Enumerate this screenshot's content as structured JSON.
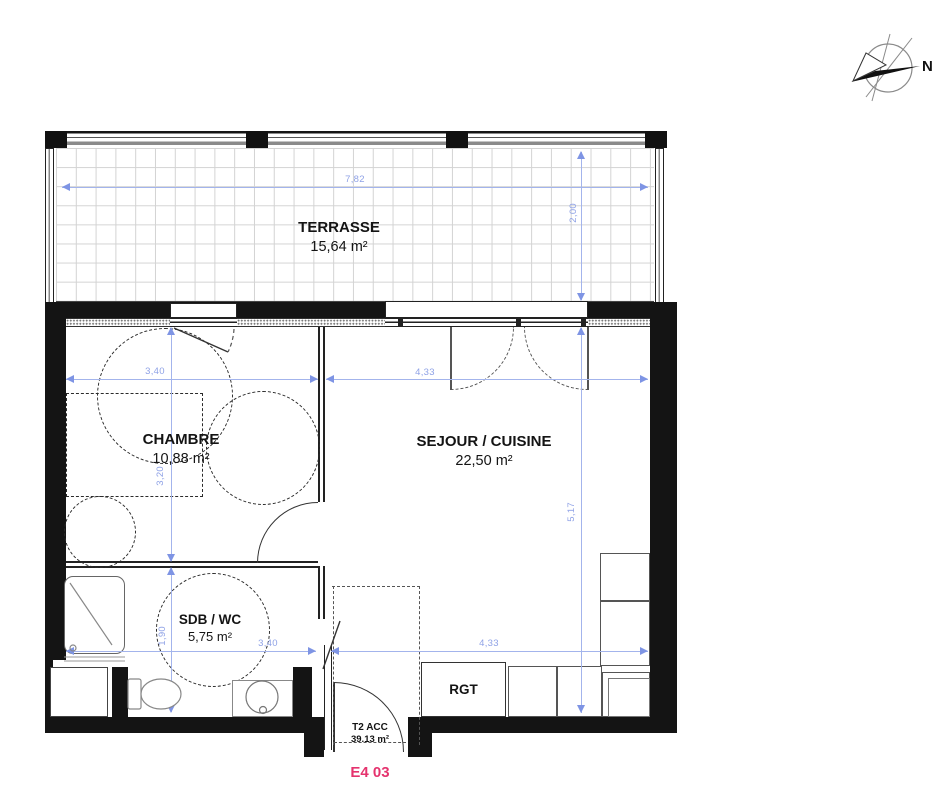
{
  "compass": {
    "label": "N"
  },
  "rooms": [
    {
      "id": "terrasse",
      "name": "TERRASSE",
      "area": "15,64 m²"
    },
    {
      "id": "chambre",
      "name": "CHAMBRE",
      "area": "10,88 m²"
    },
    {
      "id": "sejour",
      "name": "SEJOUR / CUISINE",
      "area": "22,50 m²"
    },
    {
      "id": "sdb",
      "name": "SDB / WC",
      "area": "5,75 m²"
    },
    {
      "id": "rgt",
      "name": "RGT"
    }
  ],
  "unit": {
    "type_label": "T2 ACC",
    "total_area": "39.13 m²",
    "code": "E4 03"
  },
  "dims": [
    {
      "id": "terrasse-width",
      "value": "7,82"
    },
    {
      "id": "terrasse-depth",
      "value": "2,00"
    },
    {
      "id": "chambre-width",
      "value": "3,40"
    },
    {
      "id": "sejour-width-top",
      "value": "4,33"
    },
    {
      "id": "chambre-depth",
      "value": "3,20"
    },
    {
      "id": "sdb-depth",
      "value": "1,90"
    },
    {
      "id": "sejour-depth",
      "value": "5,17"
    },
    {
      "id": "sdb-width",
      "value": "3,40"
    },
    {
      "id": "sejour-width-bottom",
      "value": "4,33"
    }
  ],
  "colors": {
    "dimension_blue": "#8fa2e6",
    "unit_code_pink": "#e5336e",
    "wall_black": "#141414"
  }
}
